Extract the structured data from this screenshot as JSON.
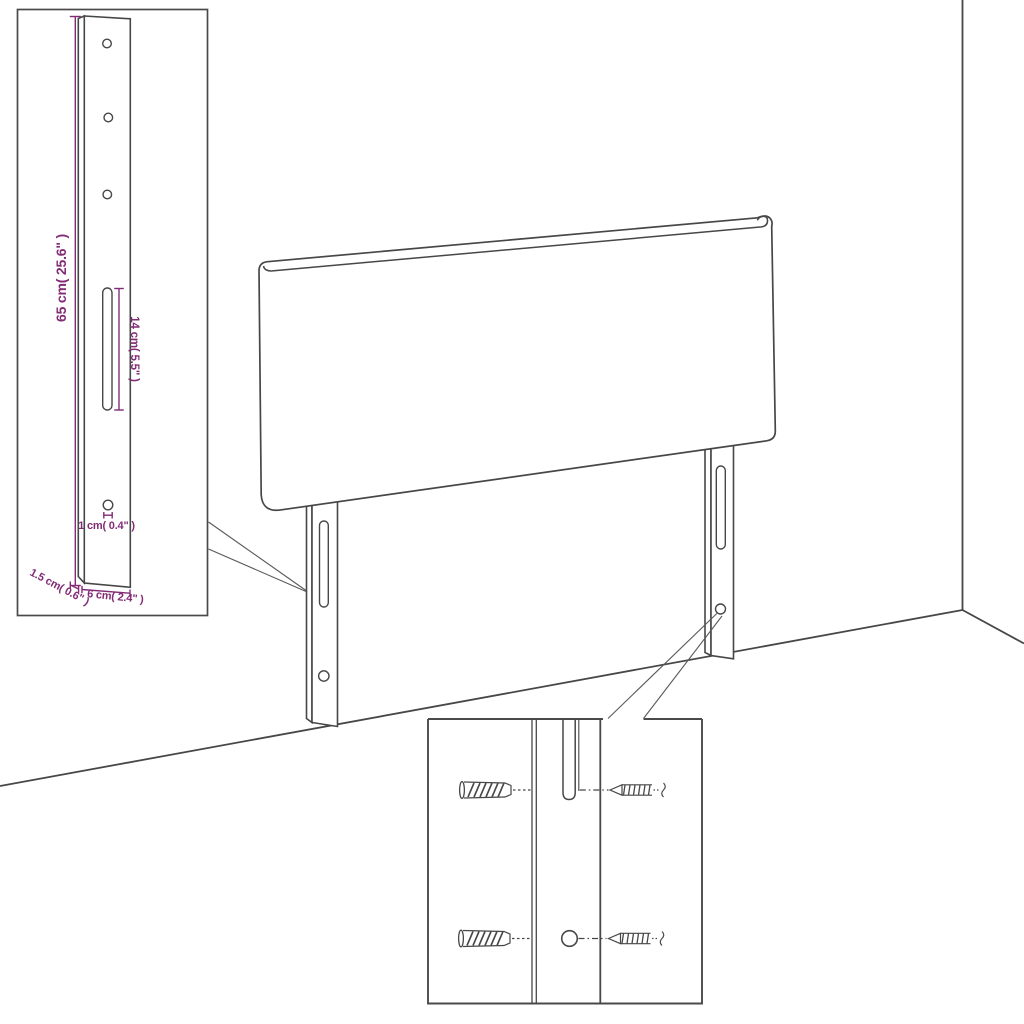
{
  "colors": {
    "background": "#ffffff",
    "line": "#474747",
    "inset_border": "#4a4a4a",
    "dimension": "#822c76"
  },
  "diagram": {
    "type": "furniture-assembly-dimension-diagram",
    "subject": "upholstered headboard with two mounting legs against a room corner",
    "bracket_inset": {
      "labels": {
        "height": "65 cm( 25.6\" )",
        "slot_length": "14 cm( 5.5\" )",
        "hole_offset": "1 cm( 0.4\" )",
        "thickness": "1.5 cm( 0.6\" )",
        "width": "6 cm( 2.4\" )"
      }
    },
    "mounting_inset": {
      "hardware": [
        "wall-plug",
        "wall-plug",
        "screw",
        "screw"
      ]
    }
  }
}
